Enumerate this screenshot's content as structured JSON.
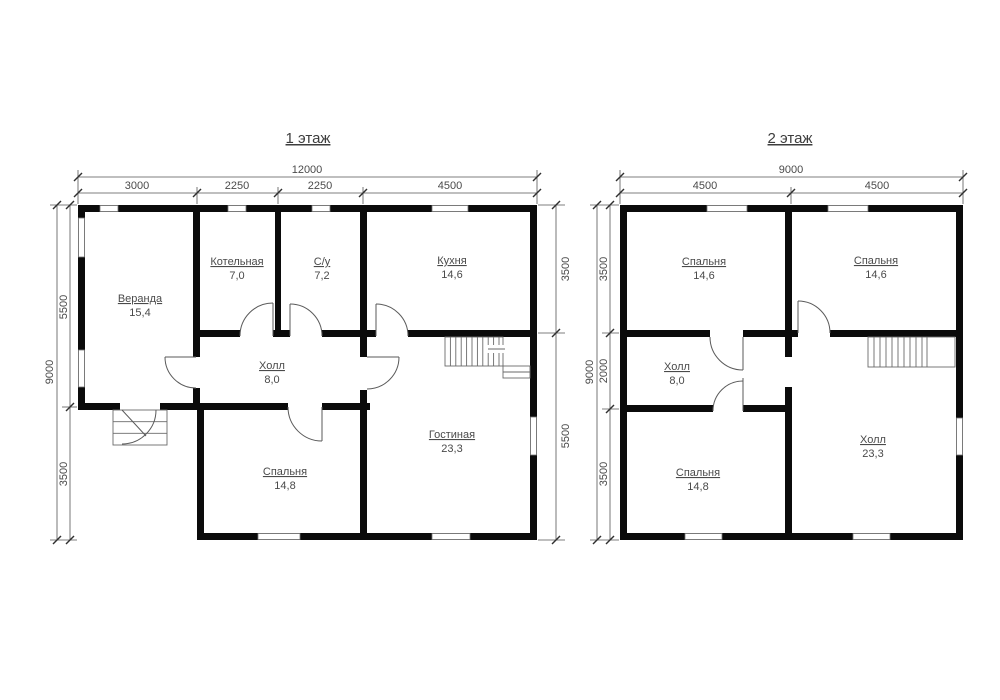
{
  "floor1": {
    "title": "1 этаж",
    "dim_top_total": "12000",
    "dim_top_segments": [
      "3000",
      "2250",
      "2250",
      "4500"
    ],
    "dim_left_total": "9000",
    "dim_left_segments": [
      "5500",
      "3500"
    ],
    "dim_right_segments": [
      "3500",
      "5500"
    ],
    "rooms": {
      "veranda": {
        "name": "Веранда",
        "area": "15,4"
      },
      "boiler": {
        "name": "Котельная",
        "area": "7,0"
      },
      "bathroom": {
        "name": "С/у",
        "area": "7,2"
      },
      "kitchen": {
        "name": "Кухня",
        "area": "14,6"
      },
      "hall": {
        "name": "Холл",
        "area": "8,0"
      },
      "living": {
        "name": "Гостиная",
        "area": "23,3"
      },
      "bedroom": {
        "name": "Спальня",
        "area": "14,8"
      }
    }
  },
  "floor2": {
    "title": "2 этаж",
    "dim_top_total": "9000",
    "dim_top_segments": [
      "4500",
      "4500"
    ],
    "dim_left_total": "9000",
    "dim_left_segments": [
      "3500",
      "2000",
      "3500"
    ],
    "rooms": {
      "bedroom1": {
        "name": "Спальня",
        "area": "14,6"
      },
      "bedroom2": {
        "name": "Спальня",
        "area": "14,6"
      },
      "hall_small": {
        "name": "Холл",
        "area": "8,0"
      },
      "hall_big": {
        "name": "Холл",
        "area": "23,3"
      },
      "bedroom3": {
        "name": "Спальня",
        "area": "14,8"
      }
    }
  },
  "colors": {
    "wall": "#0b0b0b",
    "thin_line": "#5a5a5a",
    "text": "#4a4a4a",
    "background": "#ffffff"
  }
}
